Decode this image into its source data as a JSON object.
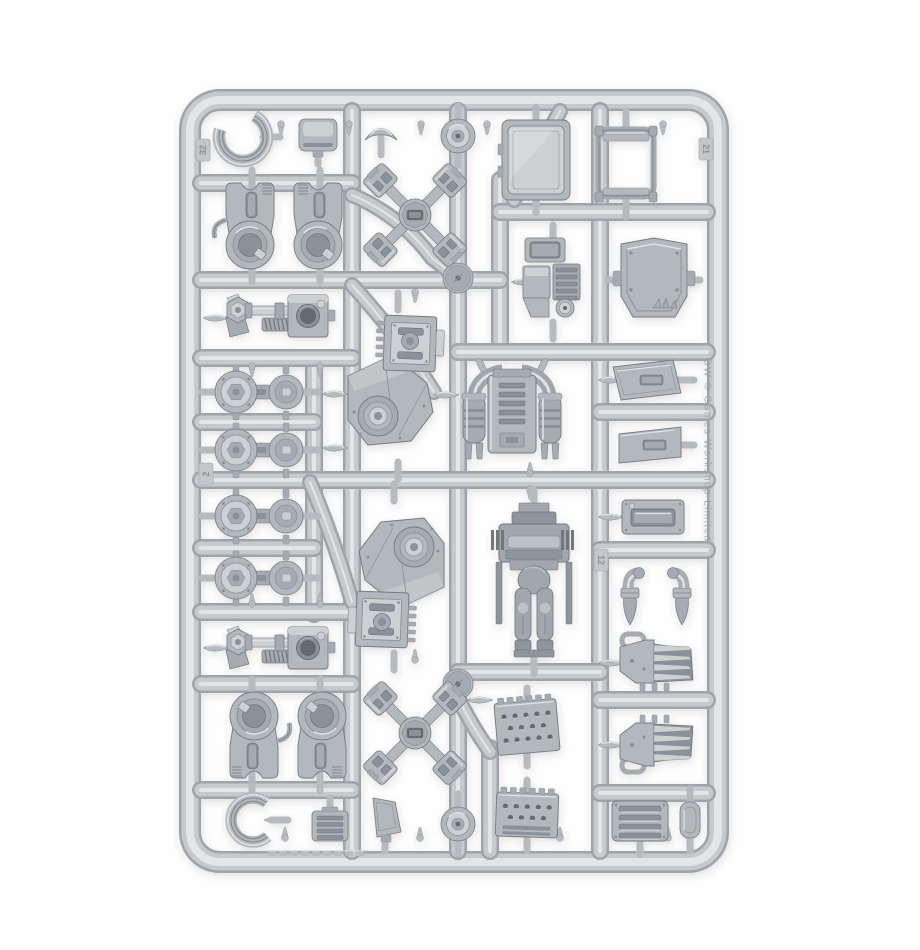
{
  "meta": {
    "description": "Product photograph of a grey plastic model kit sprue (injection-moulded parts frame) on a plain white background"
  },
  "palette": {
    "background": "#fefefe",
    "rail": "#c6cacd",
    "rail_shadow": "#9ea4aa",
    "rail_highlight": "#e3e5e6",
    "stub": "#b7bbc0",
    "part_base": "#b3b8bd",
    "part_light": "#cdd1d4",
    "part_lighter": "#dfe2e4",
    "part_mid": "#a5abb0",
    "part_shadow": "#8b9198",
    "part_dark": "#757c83",
    "part_deep": "#646a71",
    "torso_base": "#a2a7ad",
    "torso_mid": "#8f959c",
    "torso_dark": "#71777e",
    "torso_light": "#bcc1c5"
  },
  "embossed": {
    "right_rail_text": "GW © Games Workshop Limited",
    "number_tabs": [
      {
        "label": "32",
        "x": 203,
        "y": 150,
        "rot": -90
      },
      {
        "label": "21",
        "x": 706,
        "y": 149,
        "rot": 90
      },
      {
        "label": "12",
        "x": 601,
        "y": 560,
        "rot": 90
      },
      {
        "label": "2",
        "x": 206,
        "y": 474,
        "rot": -90
      }
    ]
  },
  "frame": {
    "x": 190,
    "y": 100,
    "w": 528,
    "h": 762,
    "rx": 30,
    "rail_width": 22
  },
  "runners": {
    "verticals": [
      [
        352,
        111,
        851
      ],
      [
        458,
        111,
        851
      ],
      [
        500,
        180,
        352
      ],
      [
        600,
        111,
        851
      ],
      [
        314,
        358,
        614
      ],
      [
        490,
        748,
        851
      ]
    ],
    "horizontals": [
      [
        183,
        201,
        352
      ],
      [
        280,
        201,
        500
      ],
      [
        212,
        500,
        707
      ],
      [
        352,
        458,
        707
      ],
      [
        358,
        201,
        352
      ],
      [
        480,
        201,
        707
      ],
      [
        422,
        201,
        314
      ],
      [
        548,
        201,
        314
      ],
      [
        612,
        201,
        352
      ],
      [
        672,
        458,
        600
      ],
      [
        684,
        201,
        352
      ],
      [
        790,
        201,
        352
      ],
      [
        412,
        600,
        707
      ],
      [
        550,
        600,
        707
      ],
      [
        700,
        600,
        707
      ],
      [
        793,
        600,
        707
      ]
    ],
    "curves": [
      "M352,195 Q400,215 432,258 L458,278",
      "M352,285 Q398,335 434,392",
      "M310,482 Q336,545 352,602",
      "M458,698 Q470,722 482,740 L490,752",
      "M560,111 Q534,158 514,200"
    ]
  },
  "hubs": [
    [
      458,
      278
    ],
    [
      458,
      684
    ]
  ],
  "gates": [
    [
      446,
      395,
      0
    ],
    [
      524,
      282,
      0
    ],
    [
      480,
      700,
      0
    ],
    [
      611,
      380,
      0
    ],
    [
      611,
      517,
      0
    ],
    [
      611,
      663,
      0
    ],
    [
      611,
      745,
      0
    ],
    [
      216,
      318,
      0
    ],
    [
      216,
      648,
      0
    ],
    [
      277,
      820,
      0
    ],
    [
      335,
      394,
      0
    ],
    [
      335,
      448,
      0
    ]
  ],
  "nubs": [
    [
      281,
      124,
      90
    ],
    [
      349,
      124,
      90
    ],
    [
      421,
      124,
      90
    ],
    [
      487,
      124,
      90
    ],
    [
      663,
      124,
      90
    ],
    [
      285,
      838,
      -90
    ],
    [
      420,
      838,
      -90
    ],
    [
      560,
      838,
      -90
    ],
    [
      668,
      838,
      -90
    ],
    [
      415,
      292,
      90
    ],
    [
      415,
      660,
      -90
    ],
    [
      530,
      473,
      -90
    ],
    [
      530,
      489,
      90
    ],
    [
      252,
      366,
      90
    ],
    [
      320,
      366,
      90
    ],
    [
      252,
      604,
      -90
    ],
    [
      320,
      604,
      -90
    ]
  ],
  "parts": [
    {
      "type": "cring",
      "name": "c-ring-clamp-top",
      "x": 243,
      "y": 137,
      "r": 24,
      "gap": 250,
      "stub": "r"
    },
    {
      "type": "boxsmall",
      "name": "small-box-vent",
      "x": 318,
      "y": 135,
      "w": 38,
      "h": 32,
      "stub": "d"
    },
    {
      "type": "capsmall",
      "name": "small-visor-cap",
      "x": 381,
      "y": 130,
      "w": 32,
      "h": 24,
      "stub": "d"
    },
    {
      "type": "rounddisc",
      "name": "round-hatch-disc-top",
      "x": 458,
      "y": 136,
      "stub": "v"
    },
    {
      "type": "hatchdoor",
      "name": "armour-hatch-door",
      "x": 536,
      "y": 160,
      "w": 68,
      "h": 80,
      "stub": "v"
    },
    {
      "type": "seatframe",
      "name": "cockpit-seat-frame",
      "x": 626,
      "y": 164,
      "w": 62,
      "h": 80,
      "stub": "v"
    },
    {
      "type": "hipjoint",
      "name": "hip-joint-left",
      "x": 252,
      "y": 226,
      "w": 58,
      "h": 86,
      "rot": 0,
      "variant": 0,
      "stub": "v"
    },
    {
      "type": "hipjoint",
      "name": "hip-joint-right",
      "x": 320,
      "y": 226,
      "w": 56,
      "h": 86,
      "rot": 0,
      "variant": 1,
      "stub": "v"
    },
    {
      "type": "xpart",
      "name": "quad-foot-cross-top",
      "x": 415,
      "y": 215,
      "s": 86,
      "stub": "none"
    },
    {
      "type": "engine",
      "name": "engine-block",
      "x": 553,
      "y": 282,
      "w": 64,
      "h": 88,
      "stub": "v"
    },
    {
      "type": "rearpanel",
      "name": "rear-armour-panel",
      "x": 654,
      "y": 280,
      "w": 66,
      "h": 86,
      "stub": "h"
    },
    {
      "type": "piston",
      "name": "piston-arm-upper",
      "x": 282,
      "y": 316,
      "w": 112,
      "h": 46,
      "stub": "none"
    },
    {
      "type": "leg",
      "name": "leg-assembly-upper",
      "x": 398,
      "y": 386,
      "w": 100,
      "h": 160,
      "rot": 0,
      "stub": "v"
    },
    {
      "type": "backpack",
      "name": "exhaust-backpack",
      "x": 512,
      "y": 413,
      "w": 106,
      "h": 102,
      "stub": "none"
    },
    {
      "type": "angledpanel",
      "name": "angled-plate-1",
      "x": 647,
      "y": 380,
      "w": 68,
      "h": 40,
      "variant": 0,
      "stub": "r"
    },
    {
      "type": "angledpanel",
      "name": "angled-plate-2",
      "x": 650,
      "y": 445,
      "w": 62,
      "h": 36,
      "variant": 1,
      "stub": "r"
    },
    {
      "type": "kneepair",
      "name": "joint-pair-1",
      "x": 260,
      "y": 392,
      "w": 90,
      "h": 44,
      "stub": "h"
    },
    {
      "type": "kneepair",
      "name": "joint-pair-2",
      "x": 260,
      "y": 450,
      "w": 90,
      "h": 44,
      "stub": "h"
    },
    {
      "type": "kneepair",
      "name": "joint-pair-3",
      "x": 260,
      "y": 516,
      "w": 90,
      "h": 44,
      "stub": "h"
    },
    {
      "type": "kneepair",
      "name": "joint-pair-4",
      "x": 260,
      "y": 578,
      "w": 90,
      "h": 44,
      "stub": "h"
    },
    {
      "type": "leg",
      "name": "leg-assembly-lower",
      "x": 394,
      "y": 577,
      "w": 100,
      "h": 160,
      "rot": 180,
      "stub": "v"
    },
    {
      "type": "torso",
      "name": "sarcophagus-torso",
      "x": 534,
      "y": 582,
      "w": 76,
      "h": 158,
      "stub": "v"
    },
    {
      "type": "hatchsmall",
      "name": "small-hatch-plate",
      "x": 653,
      "y": 517,
      "w": 62,
      "h": 34,
      "stub": "none"
    },
    {
      "type": "armbit",
      "name": "exhaust-bit-left",
      "x": 630,
      "y": 597,
      "w": 26,
      "h": 52,
      "variant": 0,
      "stub": "none"
    },
    {
      "type": "armbit",
      "name": "exhaust-bit-right",
      "x": 682,
      "y": 597,
      "w": 26,
      "h": 52,
      "variant": 1,
      "stub": "none"
    },
    {
      "type": "claw",
      "name": "power-fist-upper",
      "x": 656,
      "y": 661,
      "w": 72,
      "h": 54,
      "flip": false,
      "stub": "none"
    },
    {
      "type": "claw",
      "name": "power-fist-lower",
      "x": 656,
      "y": 745,
      "w": 72,
      "h": 54,
      "flip": true,
      "stub": "none"
    },
    {
      "type": "piston",
      "name": "piston-arm-lower",
      "x": 282,
      "y": 648,
      "w": 112,
      "h": 46,
      "variant": 1,
      "stub": "none"
    },
    {
      "type": "hipjoint",
      "name": "greave-left",
      "x": 252,
      "y": 735,
      "w": 58,
      "h": 86,
      "rot": 180,
      "variant": 0,
      "stub": "v"
    },
    {
      "type": "hipjoint",
      "name": "greave-right",
      "x": 320,
      "y": 735,
      "w": 56,
      "h": 86,
      "rot": 180,
      "variant": 1,
      "stub": "v"
    },
    {
      "type": "xpart",
      "name": "quad-foot-cross-bottom",
      "x": 415,
      "y": 733,
      "s": 86,
      "stub": "none"
    },
    {
      "type": "grilleplate",
      "name": "riveted-grille-plate-1",
      "x": 527,
      "y": 727,
      "w": 62,
      "h": 52,
      "rot": -5,
      "variant": 0,
      "stub": "v"
    },
    {
      "type": "grilleplate",
      "name": "riveted-grille-plate-2",
      "x": 527,
      "y": 815,
      "w": 62,
      "h": 44,
      "rot": 2,
      "variant": 1,
      "stub": "v"
    },
    {
      "type": "smallbit",
      "name": "angled-block-bit",
      "x": 385,
      "y": 818,
      "w": 34,
      "h": 40,
      "stub": "d"
    },
    {
      "type": "rounddisc",
      "name": "round-hatch-disc-bottom",
      "x": 458,
      "y": 824,
      "stub": "v"
    },
    {
      "type": "louver",
      "name": "louvered-vent-plate",
      "x": 640,
      "y": 821,
      "w": 56,
      "h": 40,
      "stub": "d"
    },
    {
      "type": "pill",
      "name": "pill-bit",
      "x": 690,
      "y": 820,
      "w": 20,
      "h": 36,
      "stub": "v"
    },
    {
      "type": "cring",
      "name": "c-ring-clamp-bottom",
      "x": 253,
      "y": 820,
      "r": 22,
      "gap": 0,
      "stub": "r"
    },
    {
      "type": "grillebox",
      "name": "small-grille-box",
      "x": 330,
      "y": 826,
      "w": 36,
      "h": 30,
      "stub": "u"
    }
  ]
}
